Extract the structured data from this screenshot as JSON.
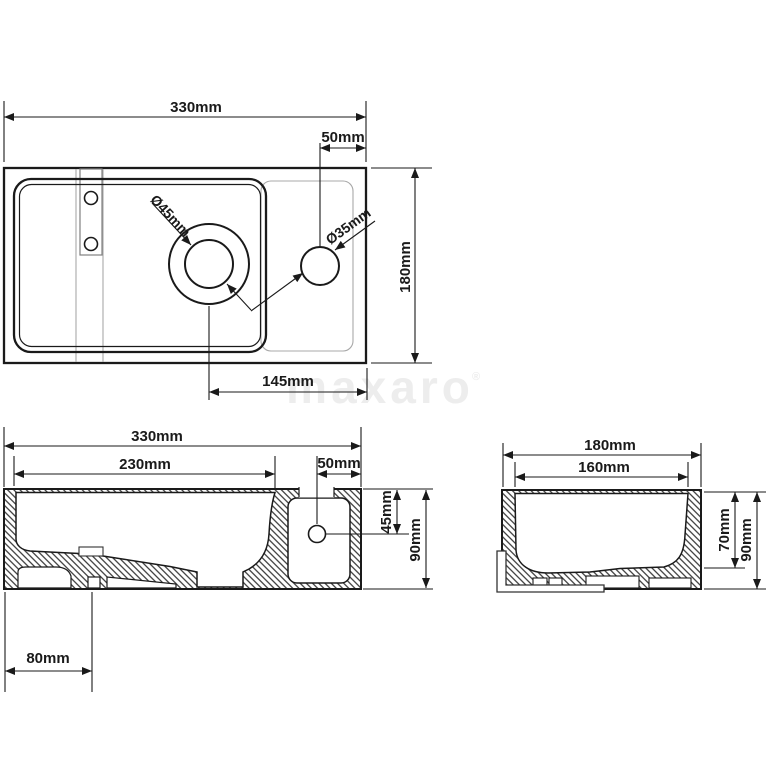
{
  "watermark": {
    "text": "maxaro",
    "registered": "®"
  },
  "colors": {
    "line": "#1a1a1a",
    "secondary_line": "#999999",
    "watermark": "#ededed",
    "background": "#ffffff"
  },
  "top_view": {
    "width_label": "330mm",
    "tap_offset_label": "50mm",
    "depth_label": "180mm",
    "drain_diameter_label": "Ø45mm",
    "tap_diameter_label": "Ø35mm",
    "drain_to_right_edge_label": "145mm"
  },
  "front_view": {
    "width_label": "330mm",
    "basin_inner_width_label": "230mm",
    "tap_offset_label": "50mm",
    "tap_hole_depth_label": "45mm",
    "height_label": "90mm",
    "drain_offset_label": "80mm"
  },
  "side_view": {
    "width_label": "180mm",
    "basin_inner_width_label": "160mm",
    "basin_depth_label": "70mm",
    "height_label": "90mm"
  }
}
